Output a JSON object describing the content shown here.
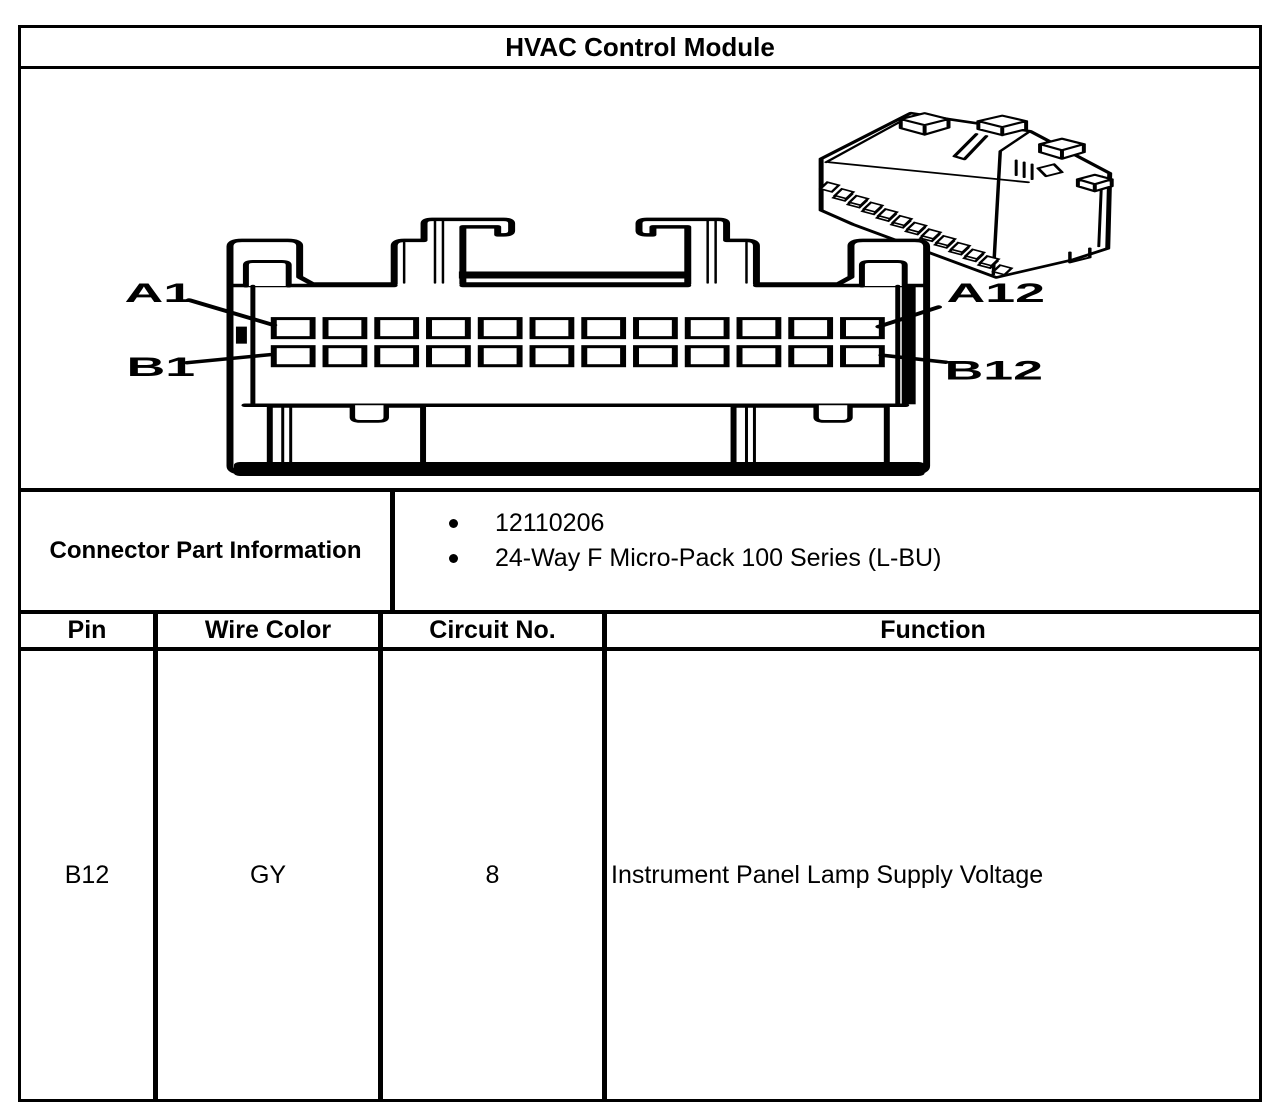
{
  "colors": {
    "ink": "#000000",
    "paper": "#ffffff"
  },
  "title": "HVAC Control Module",
  "connector_face": {
    "pin_label_a1": "A1",
    "pin_label_a12": "A12",
    "pin_label_b1": "B1",
    "pin_label_b12": "B12",
    "rows": 2,
    "pins_per_row": 12
  },
  "connector_part_information": {
    "label": "Connector Part Information",
    "items": [
      "12110206",
      "24-Way F Micro-Pack 100 Series (L-BU)"
    ]
  },
  "pin_table": {
    "headers": [
      "Pin",
      "Wire Color",
      "Circuit No.",
      "Function"
    ],
    "rows": [
      [
        "B12",
        "GY",
        "8",
        "Instrument Panel Lamp Supply Voltage"
      ]
    ]
  }
}
